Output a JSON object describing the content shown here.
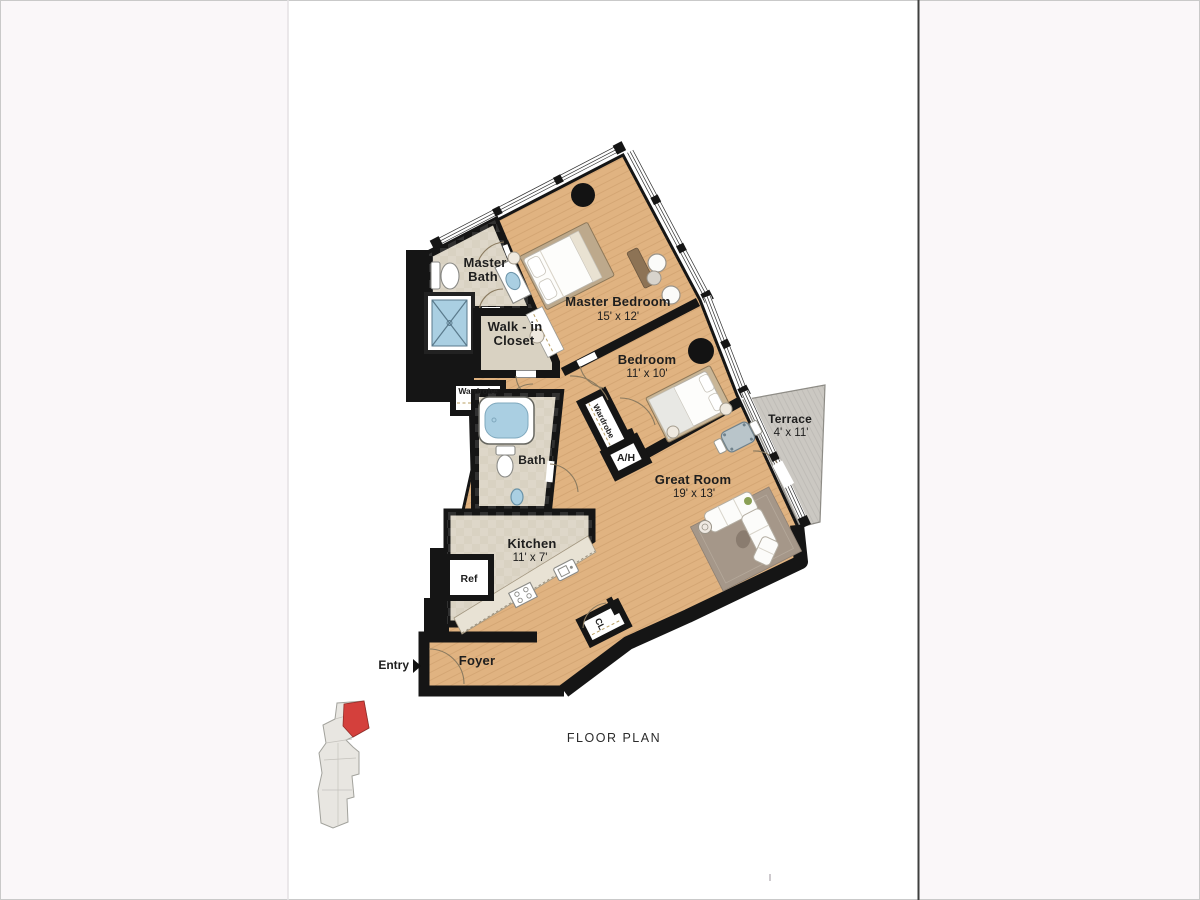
{
  "page": {
    "caption": "FLOOR PLAN"
  },
  "floor_plan": {
    "colors": {
      "wood": "#e0b381",
      "tile": "#d9d2c2",
      "wall": "#151515",
      "terrace": "#cbc8c2",
      "water": "#aacfe2",
      "rug": "#a59789",
      "key_building": "#e8e6e1",
      "key_unit_red": "#d4403c"
    },
    "rooms": {
      "master_bath": {
        "line1": "Master",
        "line2": "Bath"
      },
      "walk_in_closet": {
        "line1": "Walk - in",
        "line2": "Closet"
      },
      "master_bedroom": {
        "name": "Master Bedroom",
        "dims": "15' x 12'"
      },
      "bedroom": {
        "name": "Bedroom",
        "dims": "11' x 10'"
      },
      "great_room": {
        "name": "Great Room",
        "dims": "19' x 13'"
      },
      "terrace": {
        "name": "Terrace",
        "dims": "4' x 11'"
      },
      "kitchen": {
        "name": "Kitchen",
        "dims": "11' x 7'"
      },
      "bath": {
        "name": "Bath"
      },
      "foyer": {
        "name": "Foyer"
      },
      "air_handler": {
        "name": "A/H"
      },
      "wardrobe_upper": {
        "name": "Wardrobe"
      },
      "wardrobe_lower": {
        "name": "Wardrobe"
      },
      "refrigerator": {
        "name": "Ref"
      },
      "closet": {
        "name": "CL"
      }
    },
    "entry": {
      "label": "Entry"
    }
  }
}
